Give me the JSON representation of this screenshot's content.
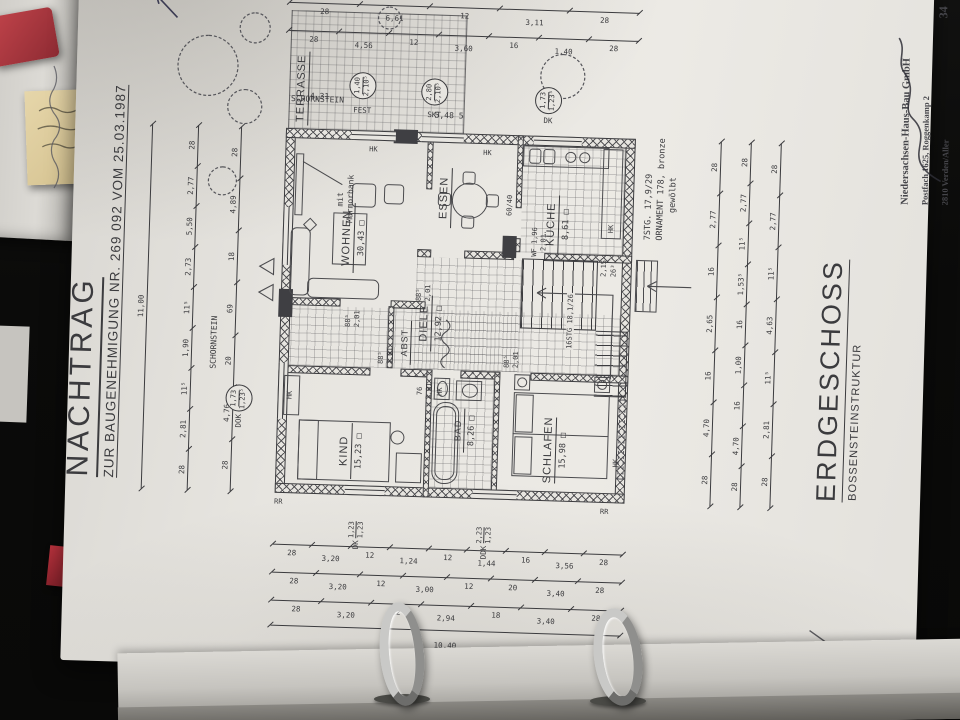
{
  "colors": {
    "background": "#0b0b0a",
    "paper": "#e7e5e0",
    "ink": "#3b3b3e",
    "accent_red": "#b5303b",
    "sticky_yellow": "#e6d6aa",
    "metal_ring": "#c9c9c7"
  },
  "title_block": {
    "line1": "NACHTRAG",
    "line2": "ZUR BAUGENEHMIGUNG  NR. 269 092  VOM  25.03.1987"
  },
  "footer": {
    "title": "ERDGESCHOSS",
    "subtitle": "BOSSENSTEINSTRUKTUR"
  },
  "stamp": {
    "line1": "Niedersachsen-Haus-Bau GmbH",
    "line2": "Postfach 1625, Roggenkamp 2",
    "line3": "2810 Verden/Aller",
    "line4": "Telefon (04231) 64031",
    "page_number": "34"
  },
  "rooms": [
    {
      "name": "WOHNEN",
      "area": "30,43 □"
    },
    {
      "name": "ESSEN",
      "area": ""
    },
    {
      "name": "KÜCHE",
      "area": "8,61 □"
    },
    {
      "name": "DIELE",
      "area": "12,92 □"
    },
    {
      "name": "ABST",
      "area": ""
    },
    {
      "name": "KIND",
      "area": "15,23 □"
    },
    {
      "name": "BAD",
      "area": "8,26 □"
    },
    {
      "name": "SCHLAFEN",
      "area": "15,98 □"
    },
    {
      "name": "TERRASSE",
      "area": ""
    }
  ],
  "dims": {
    "top_overall": [
      "11,00"
    ],
    "top_outer": [
      "28",
      "2,81",
      "11⁵",
      "1,90",
      "11⁵",
      "2,73",
      "5,50",
      "2,77",
      "28"
    ],
    "top_inner": [
      "28",
      "4,76",
      "20",
      "69",
      "18",
      "4,89",
      "28"
    ],
    "right_outer": [
      "28",
      "6,61",
      "12",
      "3,11",
      "28"
    ],
    "right_inner": [
      "28",
      "4,56",
      "12",
      "3,60",
      "16",
      "1,40",
      "28"
    ],
    "bottom_inner": [
      "28",
      "4,70",
      "16",
      "2,65",
      "16",
      "2,77",
      "28"
    ],
    "bottom_mid": [
      "28",
      "4,70",
      "16",
      "1,00",
      "16",
      "1,53⁵",
      "11⁵",
      "2,77",
      "28"
    ],
    "bottom_outer": [
      "28",
      "2,81",
      "11⁵",
      "4,63",
      "11⁵",
      "2,77",
      "28"
    ],
    "left_inner": [
      "28",
      "3,20",
      "12",
      "1,24",
      "12",
      "1,44",
      "16",
      "3,56",
      "28"
    ],
    "left_mid": [
      "28",
      "3,20",
      "12",
      "3,00",
      "12",
      "20",
      "3,40",
      "28"
    ],
    "left_outer": [
      "28",
      "3,20",
      "12",
      "2,94",
      "18",
      "3,40",
      "28"
    ],
    "left_overall": [
      "10,40"
    ]
  },
  "window_labels": [
    {
      "label": "FEST",
      "w": "1,40",
      "h": "2,10⁵",
      "x": 536,
      "y": 292,
      "lr": 90
    },
    {
      "label": "SKT",
      "w": "2,80",
      "h": "2,10⁵",
      "x": 536,
      "y": 364,
      "lr": 90
    },
    {
      "label": "DK",
      "w": "1,73",
      "h": "1,23⁵",
      "x": 536,
      "y": 478,
      "lr": 90
    },
    {
      "label": "DOK",
      "w": "1,73",
      "h": "1,23⁵",
      "x": 224,
      "y": 178,
      "lr": 0
    },
    {
      "label": "DK",
      "w": "1,23",
      "h": "1,23",
      "x": 106,
      "y": 304,
      "plain": 1
    },
    {
      "label": "DDK",
      "w": "2,23",
      "h": "1,23",
      "x": 100,
      "y": 432,
      "plain": 1
    }
  ],
  "annotations": [
    {
      "t": "SCHORNSTEIN",
      "x": 282,
      "y": 160,
      "fs": 8
    },
    {
      "t": "SCHORNSTEIN",
      "x": 528,
      "y": 256,
      "r": 90,
      "fs": 8
    },
    {
      "t": "4,31",
      "x": 548,
      "y": 258,
      "r": 90,
      "fs": 8
    },
    {
      "t": "5,48  5",
      "x": 528,
      "y": 388,
      "r": 90,
      "fs": 8
    },
    {
      "t": "mit",
      "x": 448,
      "y": 282,
      "fs": 8
    },
    {
      "t": "Marmorbank",
      "x": 432,
      "y": 292,
      "fs": 8
    },
    {
      "t": "60/40",
      "x": 444,
      "y": 452,
      "fs": 7
    },
    {
      "t": "16STG 18,1/26",
      "x": 312,
      "y": 516,
      "fs": 7,
      "bg": 1
    },
    {
      "t": "2,15",
      "x": 386,
      "y": 548,
      "fs": 7
    },
    {
      "t": "26³",
      "x": 386,
      "y": 558,
      "fs": 7
    },
    {
      "t": "7STG. 17,9/29",
      "x": 424,
      "y": 590,
      "fs": 8.5
    },
    {
      "t": "ORNAMENT 178, bronze",
      "x": 424,
      "y": 602,
      "fs": 8.5
    },
    {
      "t": "gewölbt",
      "x": 452,
      "y": 614,
      "fs": 8.5
    },
    {
      "t": "HK",
      "x": 502,
      "y": 314,
      "r": 90,
      "fs": 7
    },
    {
      "t": "HK",
      "x": 502,
      "y": 428,
      "r": 90,
      "fs": 7
    },
    {
      "t": "HK",
      "x": 430,
      "y": 554,
      "fs": 7
    },
    {
      "t": "HK",
      "x": 254,
      "y": 238,
      "fs": 7
    },
    {
      "t": "HK",
      "x": 196,
      "y": 566,
      "fs": 7
    },
    {
      "t": "HK",
      "x": 262,
      "y": 388,
      "fs": 7
    },
    {
      "t": "RR",
      "x": 147,
      "y": 230,
      "r": 90,
      "fs": 7
    },
    {
      "t": "RR",
      "x": 147,
      "y": 556,
      "r": 90,
      "fs": 7
    },
    {
      "t": "WF 1,96",
      "x": 404,
      "y": 478,
      "fs": 7
    },
    {
      "t": "2,01",
      "x": 410,
      "y": 487,
      "fs": 7
    },
    {
      "t": "88⁵",
      "x": 328,
      "y": 294,
      "fs": 7
    },
    {
      "t": "2,01",
      "x": 328,
      "y": 303,
      "fs": 7
    },
    {
      "t": "88⁵",
      "x": 292,
      "y": 328,
      "fs": 7
    },
    {
      "t": "2,01",
      "x": 292,
      "y": 337,
      "fs": 7
    },
    {
      "t": "88⁵",
      "x": 292,
      "y": 454,
      "fs": 7
    },
    {
      "t": "2,01",
      "x": 292,
      "y": 463,
      "fs": 7
    },
    {
      "t": "88⁵",
      "x": 356,
      "y": 364,
      "fs": 7
    },
    {
      "t": "2,01",
      "x": 356,
      "y": 373,
      "fs": 7
    },
    {
      "t": "76",
      "x": 262,
      "y": 368,
      "fs": 7
    },
    {
      "t": "2,01",
      "x": 258,
      "y": 377,
      "fs": 7
    }
  ]
}
